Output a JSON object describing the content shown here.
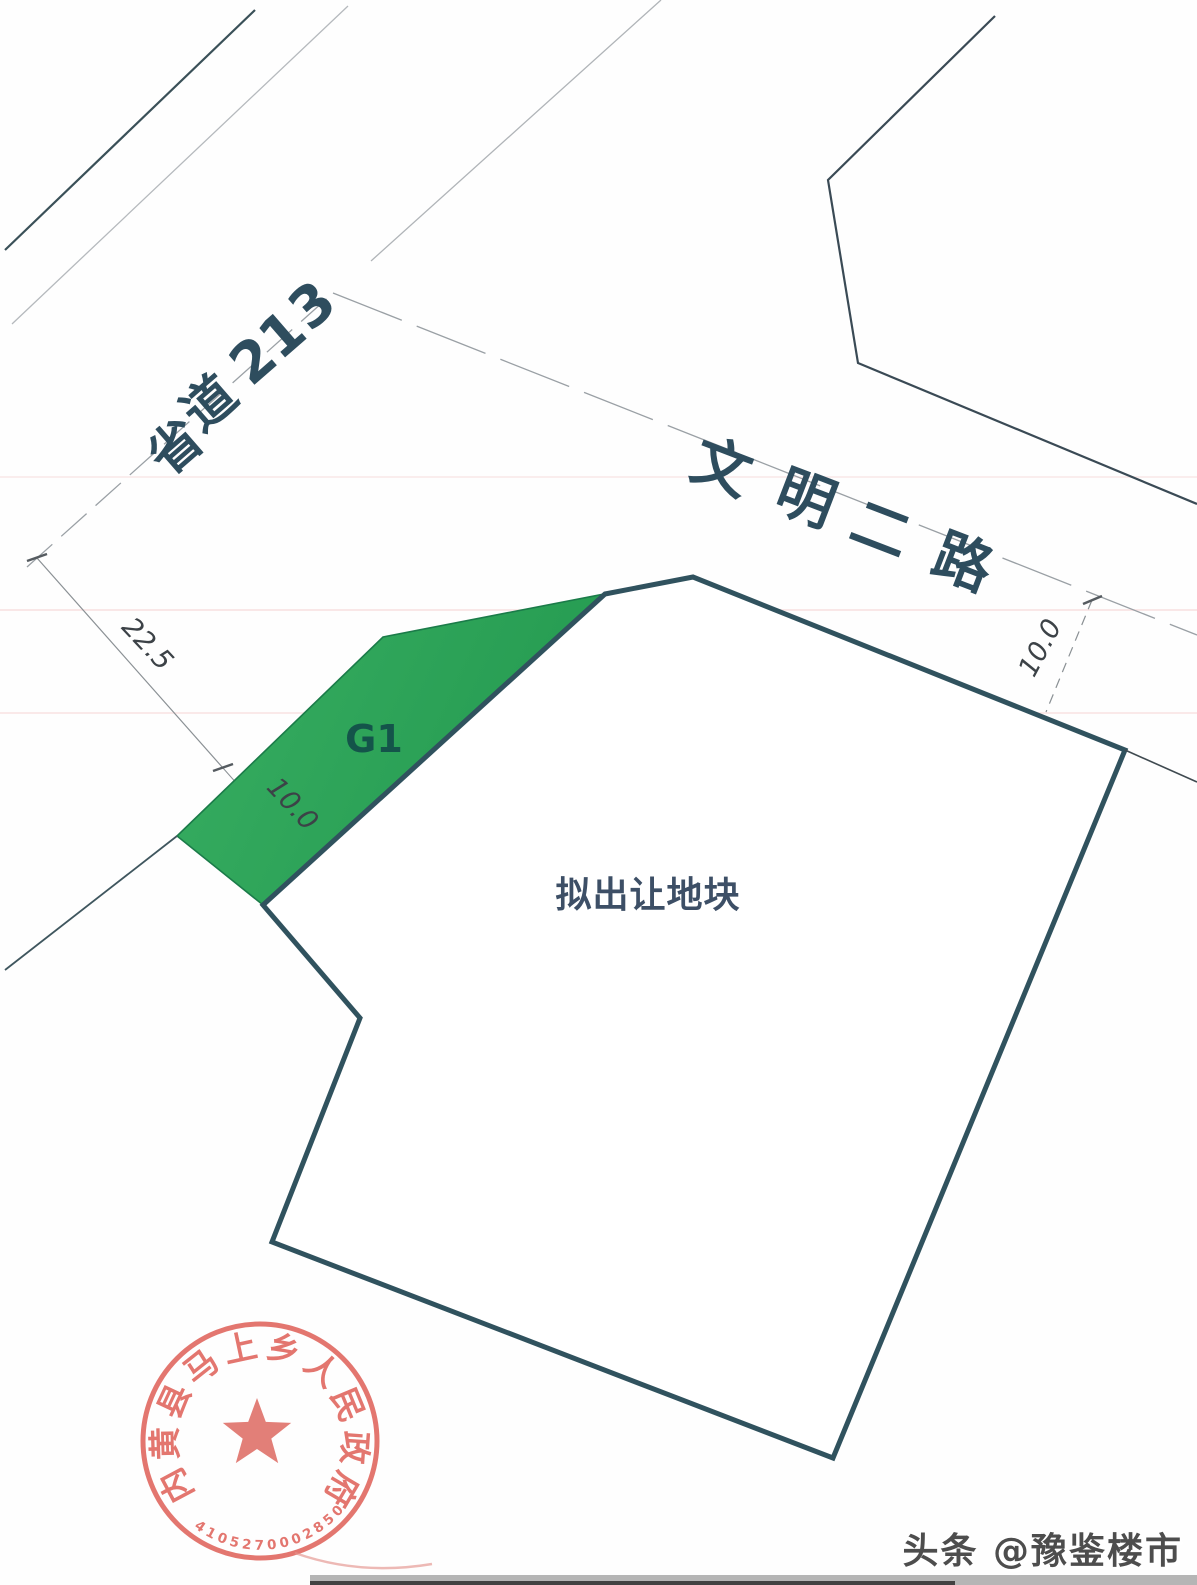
{
  "map": {
    "road_s213": {
      "name": "省道213"
    },
    "road_wenming": {
      "name": "文明二路"
    },
    "parcel": {
      "label": "拟出让地块"
    },
    "green_space": {
      "label": "G1"
    },
    "dims": {
      "left_road_width": "22.5",
      "green_strip_width": "10.0",
      "right_road_offset": "10.0"
    }
  },
  "seal": {
    "title": "内黄县马上乡人民政府",
    "serial": "4105270002850"
  },
  "watermark": {
    "text": "头条 @豫鉴楼市"
  },
  "colors": {
    "line_dark": "#3a5058",
    "line_faint": "#b5b9bd",
    "line_center": "#9aa0a5",
    "boundary": "#30525e",
    "green_fill_a": "#34ab5f",
    "green_fill_b": "#23994f",
    "green_edge": "#1b7b49",
    "label_dark": "#2e4d5e",
    "g1_text": "#14544a",
    "parcel_text": "#3d4f66",
    "dim_text": "#3c4247",
    "dim_line": "#8a9094",
    "seal_red": "#e0645c",
    "scan_pink": "rgba(235,158,158,0.22)",
    "band_gray": "#6b6b6b",
    "band_dark": "#2e2e2e"
  }
}
